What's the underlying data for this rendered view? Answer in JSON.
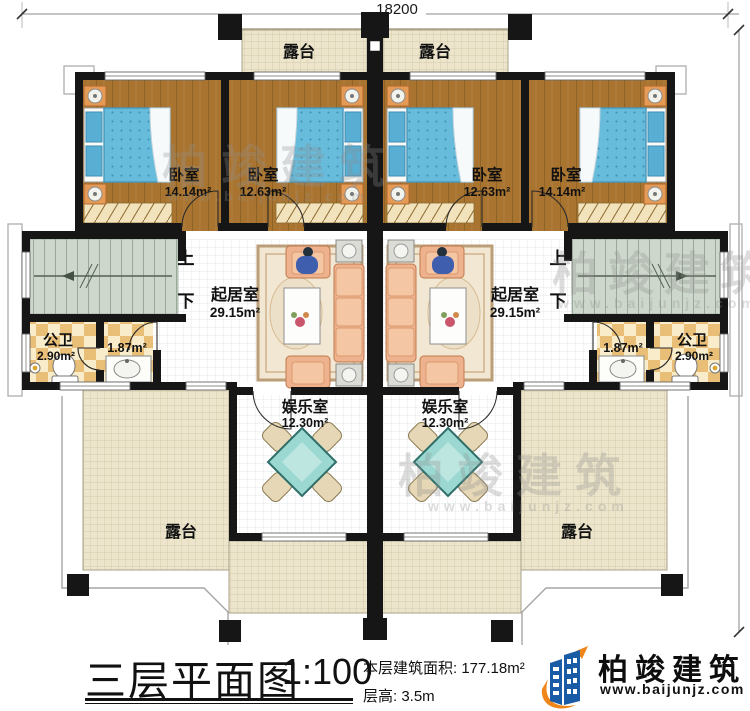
{
  "dims": {
    "top": "18200",
    "right": "15840"
  },
  "watermark": {
    "brand": "柏竣建筑",
    "site": "www.baijunjz.com"
  },
  "rooms": {
    "terraces_top": [
      {
        "name": "露台"
      },
      {
        "name": "露台"
      }
    ],
    "terraces_bottom": [
      {
        "name": "露台"
      },
      {
        "name": "露台"
      }
    ],
    "bedrooms": [
      {
        "name": "卧室",
        "area": "14.14m²"
      },
      {
        "name": "卧室",
        "area": "12.63m²"
      },
      {
        "name": "卧室",
        "area": "12.63m²"
      },
      {
        "name": "卧室",
        "area": "14.14m²"
      }
    ],
    "living": [
      {
        "name": "起居室",
        "area": "29.15m²"
      },
      {
        "name": "起居室",
        "area": "29.15m²"
      }
    ],
    "baths": [
      {
        "name": "公卫",
        "area": "2.90m²",
        "inner_area": "1.87m²"
      },
      {
        "name": "公卫",
        "area": "2.90m²",
        "inner_area": "1.87m²"
      }
    ],
    "entertainment": [
      {
        "name": "娱乐室",
        "area": "12.30m²"
      },
      {
        "name": "娱乐室",
        "area": "12.30m²"
      }
    ],
    "stairs": [
      {
        "up": "上",
        "down": "下"
      },
      {
        "up": "上",
        "down": "下"
      }
    ]
  },
  "footer": {
    "title": "三层平面图",
    "scale": "1:100",
    "area_line": "本层建筑面积: 177.18m²",
    "height_line": "层高: 3.5m",
    "brand": "柏竣建筑",
    "site": "www.baijunjz.com"
  },
  "colors": {
    "wall": "#161616",
    "wood_floor": "#a9742f",
    "bed_blue": "#67bbdb",
    "terrace": "#ece5cb",
    "stair": "#cdd7cb",
    "bath_tile": "#e9bf77",
    "sofa": "#efb28e",
    "table_teal": "#9bd8d1",
    "logo_blue": "#1a5ba6",
    "logo_orange": "#f08519"
  }
}
